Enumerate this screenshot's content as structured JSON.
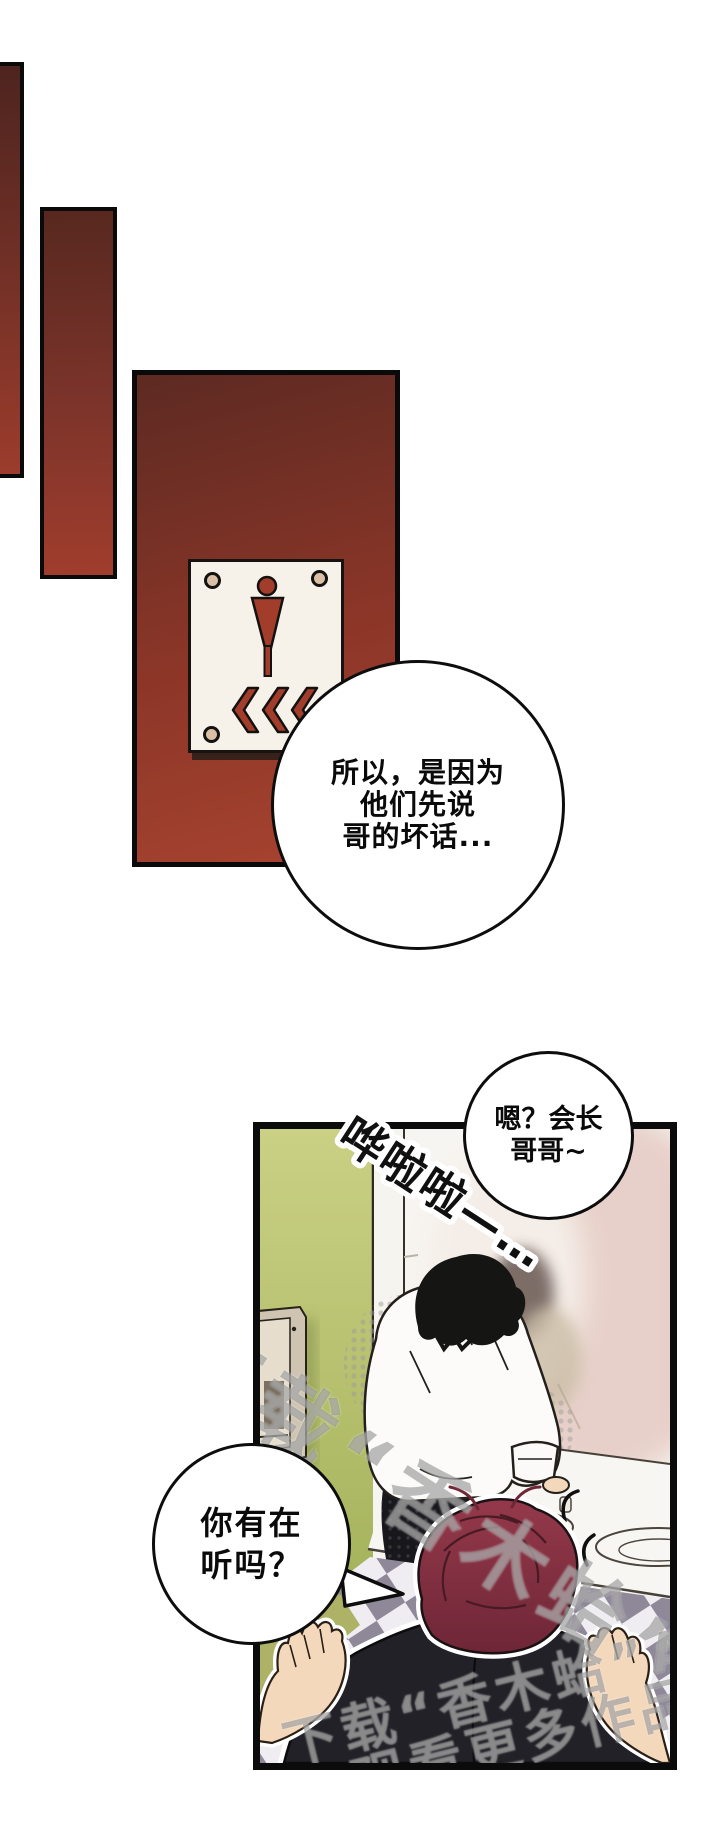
{
  "page": {
    "kind": "manhwa-comic-page",
    "width": 720,
    "height": 1821,
    "background": "#ffffff"
  },
  "bubbles": {
    "b1": {
      "lines": [
        "所以，是因为",
        "他们先说",
        "哥的坏话..."
      ]
    },
    "b2": {
      "lines": [
        "嗯？会长",
        "哥哥~"
      ]
    },
    "b3": {
      "lines": [
        "你有在",
        "听吗？"
      ]
    }
  },
  "sfx": {
    "text": "哗啦啦—…"
  },
  "watermark": {
    "line1": "下载“香木蛤”APP",
    "line2": "观看更多作品"
  },
  "icons": {
    "restroom_male_figure": "male-figure-icon",
    "chevrons": "triple-left-chevron-icon",
    "screws": "sign-screw-icon"
  },
  "colors": {
    "panel_red_top": "#5d2a22",
    "panel_red_bottom": "#a84330",
    "sign_plate": "#f6f2ea",
    "sign_icon_red": "#a23c2b",
    "sign_screw_tan": "#d8bfa5",
    "wall_green_top": "#cad084",
    "wall_green_bottom": "#9fae55",
    "mirror_pink": "#e7d0c9",
    "floor_tile_dark": "#8e8898",
    "floor_tile_light": "#efedf1",
    "floor_tile_olive": "#aeb266",
    "hair_red": "#8d3545",
    "jacket_dark": "#212127",
    "skin": "#f3d8bc",
    "outline": "#101010"
  }
}
